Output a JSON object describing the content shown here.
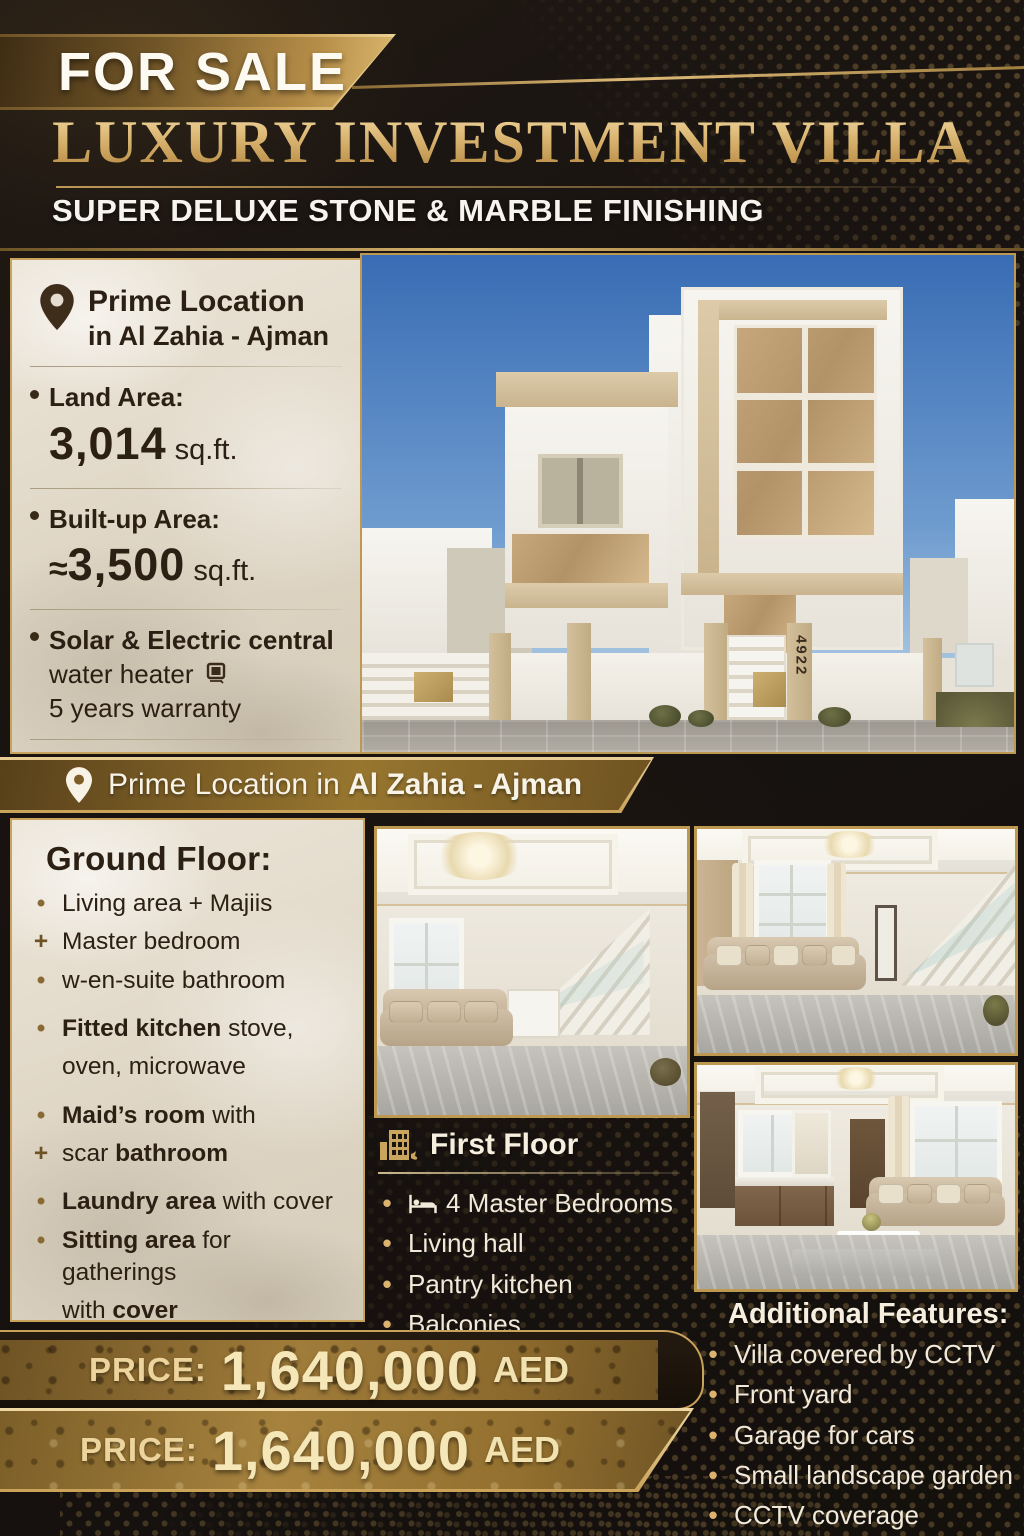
{
  "header": {
    "for_sale": "FOR SALE",
    "title": "LUXURY INVESTMENT VILLA",
    "subtitle": "SUPER DELUXE STONE & MARBLE FINISHING"
  },
  "sidebar": {
    "location": {
      "bold": "Prime",
      "rest": " Location",
      "line2": "in Al Zahia - Ajman"
    },
    "land": {
      "label": "Land Area:",
      "value": "3,014",
      "unit": " sq.ft."
    },
    "built": {
      "label": "Built-up Area:",
      "approx": "≈",
      "value": "3,500",
      "unit": " sq.ft."
    },
    "heater": {
      "line1": "Solar & Electric central",
      "line2": "water heater",
      "line3": "5 years warranty"
    },
    "warranty": {
      "bold": "1 year",
      "rest": " warranty",
      "line2": "on the house"
    }
  },
  "location_banner": {
    "prefix": "Prime Location in ",
    "bold": "Al Zahia - Ajman"
  },
  "villa": {
    "house_number": "4922"
  },
  "ground_floor": {
    "heading": "Ground Floor:",
    "rows": [
      {
        "m": "•",
        "parts": [
          {
            "t": "Living area + Majiis"
          }
        ]
      },
      {
        "m": "+",
        "parts": [
          {
            "t": "Master bedroom"
          }
        ]
      },
      {
        "m": "•",
        "parts": [
          {
            "t": "w-en-suite bathroom"
          }
        ]
      },
      {
        "m": "•",
        "gap": true,
        "parts": [
          {
            "t": "Fitted kitchen",
            "b": true
          },
          {
            "t": " stove,"
          }
        ]
      },
      {
        "m": "",
        "parts": [
          {
            "t": "oven, microwave"
          }
        ]
      },
      {
        "m": "•",
        "gap": true,
        "parts": [
          {
            "t": "Maid’s room",
            "b": true
          },
          {
            "t": " with"
          }
        ]
      },
      {
        "m": "+",
        "parts": [
          {
            "t": "scar "
          },
          {
            "t": "bathroom",
            "b": true
          }
        ]
      },
      {
        "m": "•",
        "gap": true,
        "parts": [
          {
            "t": "Laundry area",
            "b": true
          },
          {
            "t": " with cover"
          }
        ]
      },
      {
        "m": "•",
        "parts": [
          {
            "t": "Sitting area",
            "b": true
          },
          {
            "t": " for gatherings"
          }
        ]
      },
      {
        "m": "",
        "parts": [
          {
            "t": "with "
          },
          {
            "t": "cover",
            "b": true
          }
        ]
      },
      {
        "divider": true
      },
      {
        "m": "•",
        "parts": [
          {
            "t": "Small garden"
          }
        ]
      }
    ]
  },
  "first_floor": {
    "heading": "First Floor",
    "rows": [
      {
        "m": "•",
        "icon": "bed",
        "parts": [
          {
            "t": "4 Master Bedrooms"
          }
        ]
      },
      {
        "m": "•",
        "parts": [
          {
            "t": "Living hall"
          }
        ]
      },
      {
        "m": "•",
        "parts": [
          {
            "t": "Pantry kitchen"
          }
        ]
      },
      {
        "m": "•",
        "parts": [
          {
            "t": "Balconies"
          }
        ]
      }
    ]
  },
  "additional_features": {
    "heading": "Additional Features:",
    "rows": [
      {
        "m": "•",
        "parts": [
          {
            "t": "Villa covered by CCTV"
          }
        ]
      },
      {
        "m": "•",
        "parts": [
          {
            "t": "Front yard"
          }
        ]
      },
      {
        "m": "•",
        "parts": [
          {
            "t": "Garage for cars"
          }
        ]
      },
      {
        "m": "•",
        "parts": [
          {
            "t": "Small landscape garden"
          }
        ]
      },
      {
        "m": "•",
        "parts": [
          {
            "t": "CCTV coverage"
          }
        ]
      }
    ]
  },
  "prices": [
    {
      "label": "PRICE:",
      "value": "1,640,000",
      "currency": "AED"
    },
    {
      "label": "PRICE:",
      "value": "1,640,000",
      "currency": "AED"
    }
  ],
  "colors": {
    "gold": "#cfa45e",
    "dark": "#17120e",
    "marble": "#e5ddcf",
    "ink": "#2c2014"
  }
}
